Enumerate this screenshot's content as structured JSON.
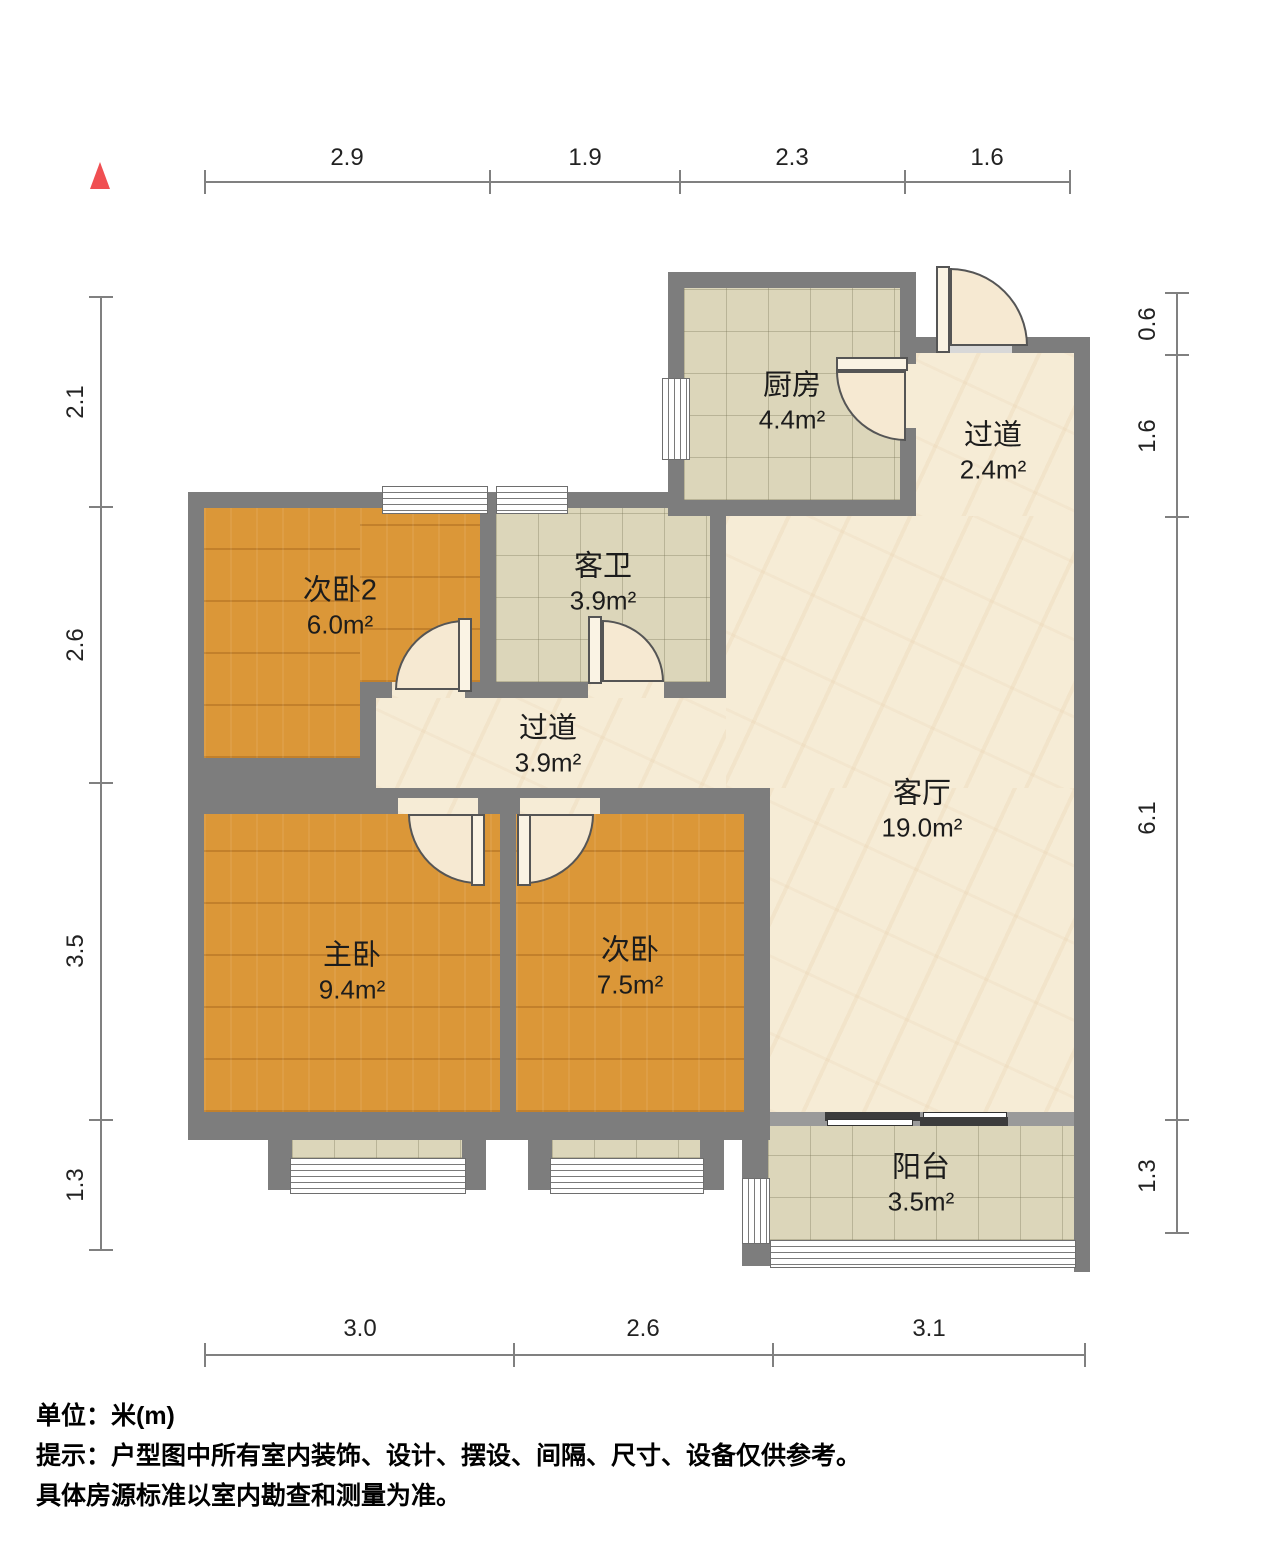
{
  "plan": {
    "title": "户型图",
    "rooms": {
      "kitchen": {
        "name": "厨房",
        "area": "4.4m²"
      },
      "entry_hall": {
        "name": "过道",
        "area": "2.4m²"
      },
      "bedroom2": {
        "name": "次卧2",
        "area": "6.0m²"
      },
      "guest_bath": {
        "name": "客卫",
        "area": "3.9m²"
      },
      "inner_hall": {
        "name": "过道",
        "area": "3.9m²"
      },
      "living": {
        "name": "客厅",
        "area": "19.0m²"
      },
      "master": {
        "name": "主卧",
        "area": "9.4m²"
      },
      "bedroom": {
        "name": "次卧",
        "area": "7.5m²"
      },
      "balcony": {
        "name": "阳台",
        "area": "3.5m²"
      }
    },
    "dims": {
      "top": [
        "2.9",
        "1.9",
        "2.3",
        "1.6"
      ],
      "left": [
        "2.1",
        "2.6",
        "3.5",
        "1.3"
      ],
      "right": [
        "0.6",
        "1.6",
        "6.1",
        "1.3"
      ],
      "bottom": [
        "3.0",
        "2.6",
        "3.1"
      ]
    },
    "notes": {
      "unit": "单位：米(m)",
      "tip1": "提示：户型图中所有室内装饰、设计、摆设、间隔、尺寸、设备仅供参考。",
      "tip2": "具体房源标准以室内勘查和测量为准。"
    },
    "colors": {
      "wall": "#7d7d7d",
      "wall_light": "#9a9a9a",
      "wood_floor": "#db9738",
      "tile_floor": "#dcd6ba",
      "marble_floor": "#f6ecd6",
      "dimension": "#808080",
      "north_marker": "#f04f52"
    },
    "icons": [
      "north-triangle-icon"
    ]
  }
}
